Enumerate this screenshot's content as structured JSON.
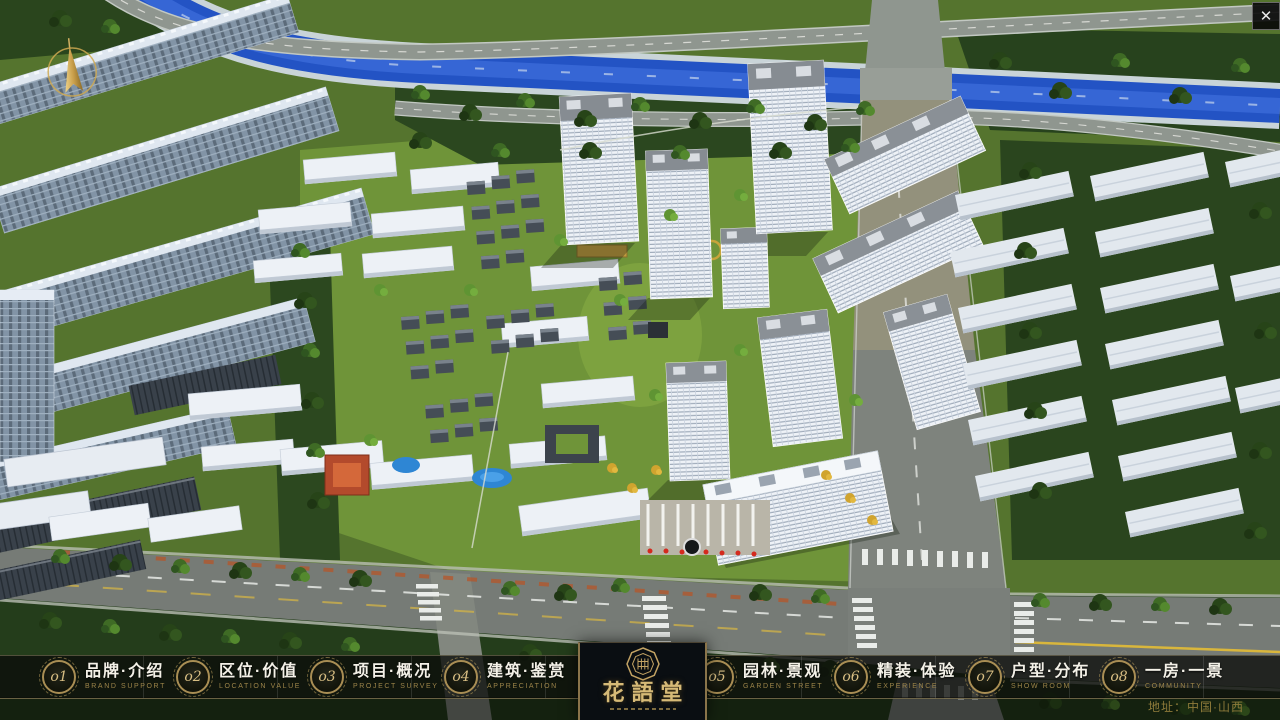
{
  "window": {
    "close_label": "✕"
  },
  "nav": {
    "items": [
      {
        "num": "o1",
        "zh": "品牌·介绍",
        "en": "BRAND SUPPORT"
      },
      {
        "num": "o2",
        "zh": "区位·价值",
        "en": "LOCATION VALUE"
      },
      {
        "num": "o3",
        "zh": "项目·概况",
        "en": "PROJECT SURVEY"
      },
      {
        "num": "o4",
        "zh": "建筑·鉴赏",
        "en": "APPRECIATION"
      },
      {
        "num": "o5",
        "zh": "园林·景观",
        "en": "GARDEN STREET"
      },
      {
        "num": "o6",
        "zh": "精装·体验",
        "en": "EXPERIENCE"
      },
      {
        "num": "o7",
        "zh": "户型·分布",
        "en": "SHOW ROOM"
      },
      {
        "num": "o8",
        "zh": "一房·一景",
        "en": "COMMUNITY"
      }
    ]
  },
  "logo": {
    "name": "花語堂"
  },
  "footer": {
    "address": "地址：中国·山西"
  },
  "colors": {
    "accent_gold": "#c9a96a",
    "bar_bg": "rgba(10,12,9,0.78)",
    "river_blue": "#2353c4"
  }
}
